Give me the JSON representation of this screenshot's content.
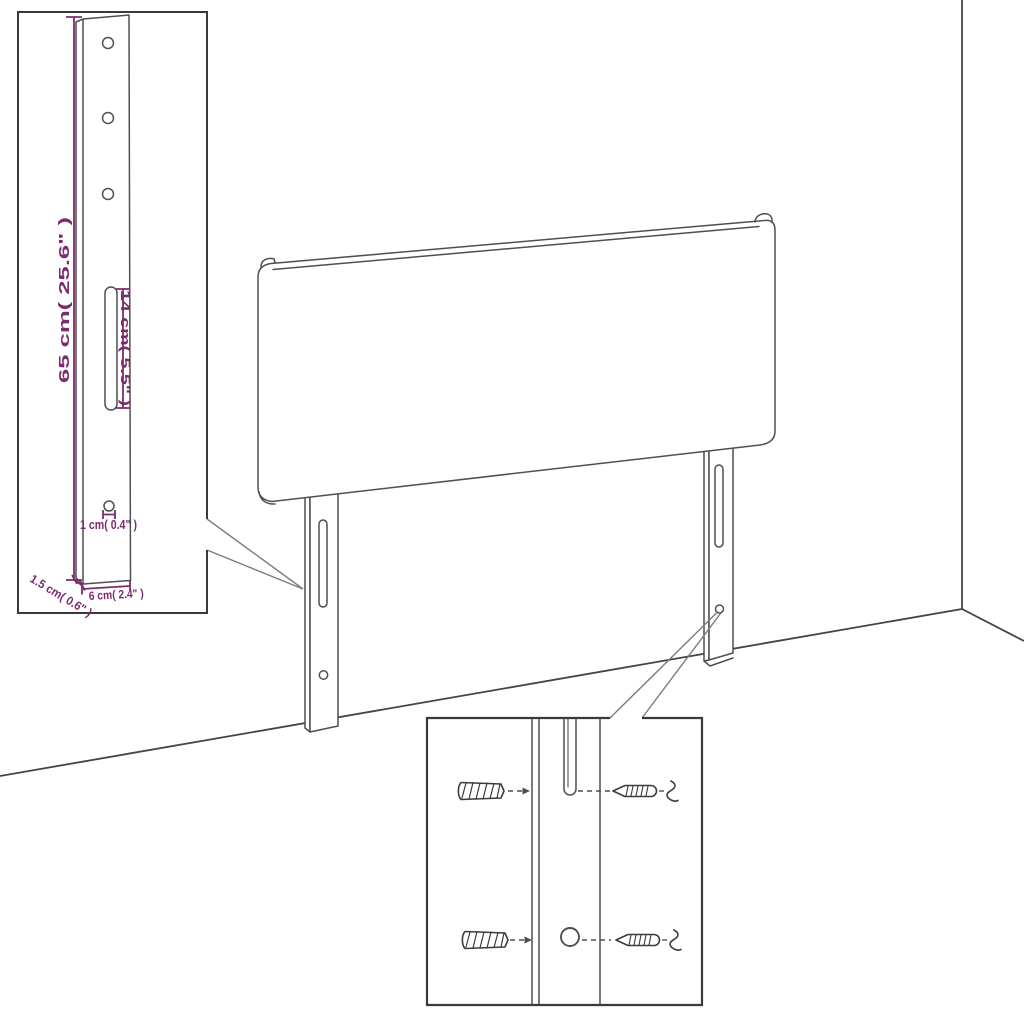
{
  "diagram": {
    "name": "headboard-wall-mount-dimension-diagram",
    "background_color": "#ffffff",
    "accent_color": "#7d2b6e",
    "line_color": "#4f4f4f"
  },
  "leg_detail_inset": {
    "height_label": "65 cm( 25.6\" )",
    "slot_label": "14 cm( 5.5\" )",
    "hole_label": "1 cm( 0.4\" )",
    "depth_label": "1.5 cm( 0.6\" )",
    "width_label": "6 cm( 2.4\" )"
  },
  "mounting_inset": {
    "hardware_icons": [
      "wall-plug-icon",
      "screw-icon"
    ]
  }
}
